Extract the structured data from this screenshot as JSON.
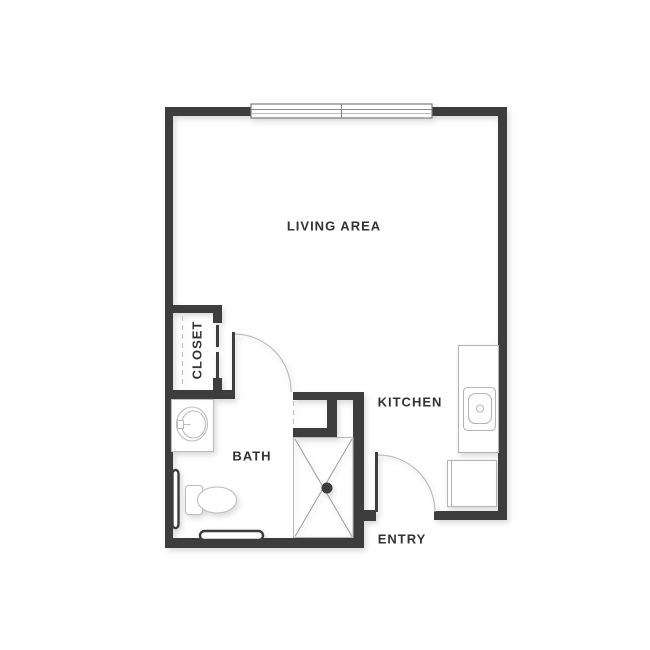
{
  "page": {
    "title": "Studio apartment floor plan",
    "background_color": "#ffffff"
  },
  "floorplan": {
    "colors": {
      "wall": "#3d3d3d",
      "fixture_line": "#bcbcbc",
      "shower_x_line": "#9a9a9a",
      "label_text": "#333333"
    },
    "labels": {
      "living": {
        "text": "LIVING AREA"
      },
      "closet": {
        "text": "CLOSET"
      },
      "bath": {
        "text": "BATH"
      },
      "kitchen": {
        "text": "KITCHEN"
      },
      "entry": {
        "text": "ENTRY"
      }
    }
  }
}
